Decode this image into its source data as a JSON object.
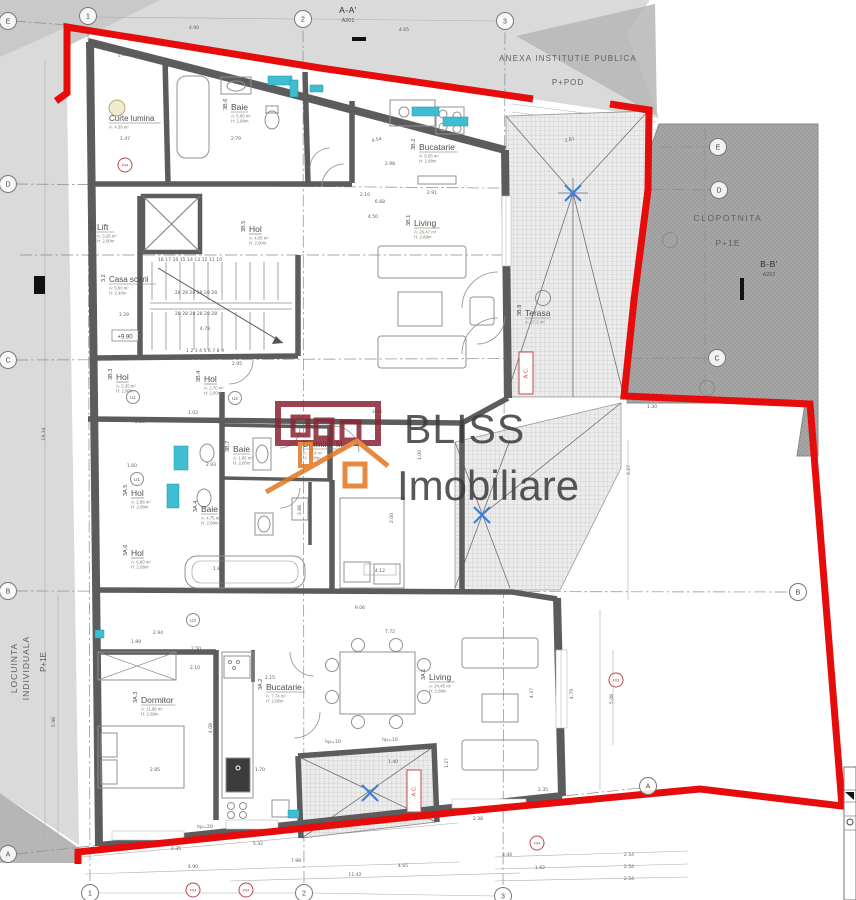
{
  "logo": {
    "line1": "BLISS",
    "line2": "Imobiliare"
  },
  "level_marker": "+9.90",
  "colors": {
    "boundary": "#e60c0c",
    "accent_teal": "#3fbdd1",
    "logo_red": "#8a2433",
    "logo_orange": "#e2761f"
  },
  "context_labels": [
    {
      "t": "ANEXA INSTITUTIE PUBLICA",
      "x": 568,
      "y": 61,
      "s": 8,
      "ls": 1.2
    },
    {
      "t": "P+POD",
      "x": 568,
      "y": 85,
      "s": 8,
      "ls": 1
    },
    {
      "t": "CLOPOTNITA",
      "x": 728,
      "y": 221,
      "s": 8.5,
      "ls": 1.5
    },
    {
      "t": "P+1E",
      "x": 728,
      "y": 246,
      "s": 8.5,
      "ls": 1
    },
    {
      "t": "LOCUINTA",
      "x": 17,
      "y": 668,
      "s": 8.5,
      "r": -90,
      "ls": 1
    },
    {
      "t": "INDIVIDUALA",
      "x": 29,
      "y": 668,
      "s": 8.5,
      "r": -90,
      "ls": 1
    },
    {
      "t": "P+1E",
      "x": 46,
      "y": 662,
      "s": 8,
      "r": -90
    }
  ],
  "section_markers": [
    {
      "label": "A-A'",
      "sub": "A201",
      "x": 348,
      "y": 13
    },
    {
      "label": "B-B'",
      "sub": "A202",
      "x": 769,
      "y": 267
    }
  ],
  "grid_markers": [
    {
      "t": "1",
      "x": 88,
      "y": 16
    },
    {
      "t": "2",
      "x": 303,
      "y": 19
    },
    {
      "t": "3",
      "x": 505,
      "y": 21
    },
    {
      "t": "E",
      "x": 8,
      "y": 21
    },
    {
      "t": "D",
      "x": 8,
      "y": 184
    },
    {
      "t": "C",
      "x": 8,
      "y": 360
    },
    {
      "t": "B",
      "x": 8,
      "y": 591
    },
    {
      "t": "A",
      "x": 8,
      "y": 854
    },
    {
      "t": "E",
      "x": 718,
      "y": 147
    },
    {
      "t": "D",
      "x": 719,
      "y": 190
    },
    {
      "t": "C",
      "x": 717,
      "y": 358
    },
    {
      "t": "B",
      "x": 798,
      "y": 592
    },
    {
      "t": "A",
      "x": 648,
      "y": 786
    },
    {
      "t": "1",
      "x": 90,
      "y": 893
    },
    {
      "t": "2",
      "x": 304,
      "y": 893
    },
    {
      "t": "3",
      "x": 503,
      "y": 896
    }
  ],
  "ref_markers": [
    {
      "t": "F04",
      "x": 125,
      "y": 165
    },
    {
      "t": "F04",
      "x": 193,
      "y": 890
    },
    {
      "t": "F04",
      "x": 246,
      "y": 890
    },
    {
      "t": "F04",
      "x": 537,
      "y": 843
    },
    {
      "t": "F03",
      "x": 616,
      "y": 680
    }
  ],
  "door_markers": [
    {
      "t": "U1",
      "x": 133,
      "y": 397
    },
    {
      "t": "U2",
      "x": 235,
      "y": 398
    },
    {
      "t": "U1",
      "x": 137,
      "y": 479
    },
    {
      "t": "U3",
      "x": 193,
      "y": 620
    }
  ],
  "plain_circles": [
    {
      "x": 543,
      "y": 298
    },
    {
      "x": 670,
      "y": 240
    },
    {
      "x": 707,
      "y": 388
    }
  ],
  "rooms": [
    {
      "id": "",
      "name": "Curte lumina",
      "a": "A: 4,39 m²",
      "h": "",
      "x": 108,
      "y": 121
    },
    {
      "id": "3.1",
      "name": "Lift",
      "a": "A: 3,26 m²",
      "h": "H: 2,80m",
      "x": 96,
      "y": 230
    },
    {
      "id": "3.2",
      "name": "Casa scarii",
      "a": "A: 5,90 m²",
      "h": "H: 2,40m",
      "x": 108,
      "y": 282
    },
    {
      "id": "3B.5",
      "name": "Hol",
      "a": "A: 4,05 m²",
      "h": "H: 2,80m",
      "x": 248,
      "y": 232
    },
    {
      "id": "3B.6",
      "name": "Baie",
      "a": "A: 5,66 m²",
      "h": "H: 2,88m",
      "x": 230,
      "y": 110
    },
    {
      "id": "3B.2",
      "name": "Bucatarie",
      "a": "A: 9,55 m²",
      "h": "H: 2,88m",
      "x": 418,
      "y": 150
    },
    {
      "id": "3B.1",
      "name": "Living",
      "a": "A: 26,47 m²",
      "h": "H: 2,88m",
      "x": 413,
      "y": 226
    },
    {
      "id": "3B.3",
      "name": "Hol",
      "a": "A: 2,35 m²",
      "h": "H: 2,80m",
      "x": 115,
      "y": 380
    },
    {
      "id": "3B.4",
      "name": "Hol",
      "a": "A: 2,70 m²",
      "h": "H: 2,80m",
      "x": 203,
      "y": 382
    },
    {
      "id": "3B.7",
      "name": "Baie",
      "a": "A: 1,95 m²",
      "h": "H: 2,80m",
      "x": 232,
      "y": 452
    },
    {
      "id": "3B.8",
      "name": "Terasa",
      "a": "A: 27,2 m²",
      "h": "",
      "x": 524,
      "y": 316
    },
    {
      "id": "3A.5",
      "name": "Hol",
      "a": "A: 2,88 m²",
      "h": "H: 2,88m",
      "x": 130,
      "y": 496
    },
    {
      "id": "3A.4",
      "name": "Baie",
      "a": "A: 4,75 m²",
      "h": "H: 2,88m",
      "x": 200,
      "y": 512
    },
    {
      "id": "3A.6",
      "name": "Hol",
      "a": "A: 6,60 m²",
      "h": "H: 2,88m",
      "x": 130,
      "y": 556
    },
    {
      "id": "",
      "name": "Dormitor M",
      "a": "A: 11,4 m²",
      "h": "H: 2,88m",
      "x": 302,
      "y": 447
    },
    {
      "id": "3A.3",
      "name": "Dormitor",
      "a": "A: 11,96 m²",
      "h": "H: 2,88m",
      "x": 140,
      "y": 703
    },
    {
      "id": "3A.2",
      "name": "Bucatarie",
      "a": "A: 7,74 m²",
      "h": "H: 2,88m",
      "x": 265,
      "y": 690
    },
    {
      "id": "3A.1",
      "name": "Living",
      "a": "A: 24,45 m²",
      "h": "H: 2,88m",
      "x": 428,
      "y": 680
    }
  ],
  "ac_labels": [
    {
      "t": "A.C.",
      "x": 526,
      "y": 373
    },
    {
      "t": "A.C.",
      "x": 414,
      "y": 791
    }
  ],
  "dimensions": [
    {
      "t": "4.90",
      "x": 194,
      "y": 29
    },
    {
      "t": "4.65",
      "x": 404,
      "y": 31
    },
    {
      "t": "1.51",
      "x": 123,
      "y": 56,
      "r": -13
    },
    {
      "t": "2.79",
      "x": 236,
      "y": 140
    },
    {
      "t": "1.47",
      "x": 125,
      "y": 140
    },
    {
      "t": "4.54",
      "x": 377,
      "y": 141,
      "r": -14
    },
    {
      "t": "2.98",
      "x": 390,
      "y": 165
    },
    {
      "t": "2.10",
      "x": 365,
      "y": 196
    },
    {
      "t": "6.68",
      "x": 380,
      "y": 203
    },
    {
      "t": "2.91",
      "x": 432,
      "y": 194
    },
    {
      "t": "4.50",
      "x": 373,
      "y": 218
    },
    {
      "t": "2.81",
      "x": 570,
      "y": 141,
      "r": -14
    },
    {
      "t": "1.30",
      "x": 652,
      "y": 408
    },
    {
      "t": "2.95",
      "x": 237,
      "y": 365
    },
    {
      "t": "1.02",
      "x": 193,
      "y": 414
    },
    {
      "t": "2.10",
      "x": 140,
      "y": 423
    },
    {
      "t": "1.60",
      "x": 132,
      "y": 467
    },
    {
      "t": "2.93",
      "x": 211,
      "y": 466
    },
    {
      "t": "3.24",
      "x": 377,
      "y": 413
    },
    {
      "t": "1.80",
      "x": 218,
      "y": 570
    },
    {
      "t": "4.12",
      "x": 380,
      "y": 572
    },
    {
      "t": "9.06",
      "x": 360,
      "y": 609
    },
    {
      "t": "7.72",
      "x": 390,
      "y": 633
    },
    {
      "t": "2.94",
      "x": 158,
      "y": 634
    },
    {
      "t": "1.89",
      "x": 136,
      "y": 643
    },
    {
      "t": "2.50",
      "x": 196,
      "y": 650
    },
    {
      "t": "2.10",
      "x": 195,
      "y": 669
    },
    {
      "t": "2.15",
      "x": 270,
      "y": 679
    },
    {
      "t": "2.85",
      "x": 155,
      "y": 771
    },
    {
      "t": "1.70",
      "x": 260,
      "y": 771
    },
    {
      "t": "1.40",
      "x": 393,
      "y": 763
    },
    {
      "t": "2.38",
      "x": 478,
      "y": 820
    },
    {
      "t": "2.35",
      "x": 543,
      "y": 791
    },
    {
      "t": "4.37",
      "x": 533,
      "y": 693,
      "r": -90
    },
    {
      "t": "1.27",
      "x": 448,
      "y": 763,
      "r": -90
    },
    {
      "t": "4.79",
      "x": 573,
      "y": 694,
      "r": -90
    },
    {
      "t": "5.08",
      "x": 613,
      "y": 699,
      "r": -90
    },
    {
      "t": "3.27",
      "x": 630,
      "y": 470,
      "r": -90
    },
    {
      "t": "19.34",
      "x": 45,
      "y": 434,
      "r": -90
    },
    {
      "t": "5.98",
      "x": 55,
      "y": 722,
      "r": -90
    },
    {
      "t": "4.08",
      "x": 212,
      "y": 728,
      "r": -90
    },
    {
      "t": "1.00",
      "x": 421,
      "y": 455,
      "r": -90
    },
    {
      "t": "3.88",
      "x": 301,
      "y": 510,
      "r": -90
    },
    {
      "t": "2.00",
      "x": 393,
      "y": 518,
      "r": -90
    },
    {
      "t": "3.44",
      "x": 507,
      "y": 856
    },
    {
      "t": "1.62",
      "x": 540,
      "y": 869
    },
    {
      "t": "2.54",
      "x": 629,
      "y": 856
    },
    {
      "t": "2.54",
      "x": 629,
      "y": 868
    },
    {
      "t": "2.54",
      "x": 629,
      "y": 880
    },
    {
      "t": "4.90",
      "x": 193,
      "y": 868
    },
    {
      "t": "7.98",
      "x": 296,
      "y": 862
    },
    {
      "t": "11.42",
      "x": 355,
      "y": 876
    },
    {
      "t": "4.65",
      "x": 403,
      "y": 867
    },
    {
      "t": "5.32",
      "x": 258,
      "y": 845
    },
    {
      "t": "2.35",
      "x": 176,
      "y": 850
    },
    {
      "t": "4.78",
      "x": 205,
      "y": 330
    },
    {
      "t": "1.29",
      "x": 124,
      "y": 316
    },
    {
      "t": "hp=10",
      "x": 333,
      "y": 743,
      "s": 3.8
    },
    {
      "t": "hp=10",
      "x": 390,
      "y": 741,
      "s": 3.8
    },
    {
      "t": "hp=20",
      "x": 205,
      "y": 828,
      "s": 3.8
    },
    {
      "t": "1 2 3 4 5 6 7 8 9",
      "x": 205,
      "y": 352,
      "s": 3.4
    },
    {
      "t": "18 17 16 15 14 13 12 11 10",
      "x": 190,
      "y": 261,
      "s": 3.3
    },
    {
      "t": "28 28 28 28 28 28",
      "x": 196,
      "y": 294,
      "s": 3.3
    },
    {
      "t": "28 28 28 28 28 28",
      "x": 196,
      "y": 315,
      "s": 3.3
    }
  ]
}
